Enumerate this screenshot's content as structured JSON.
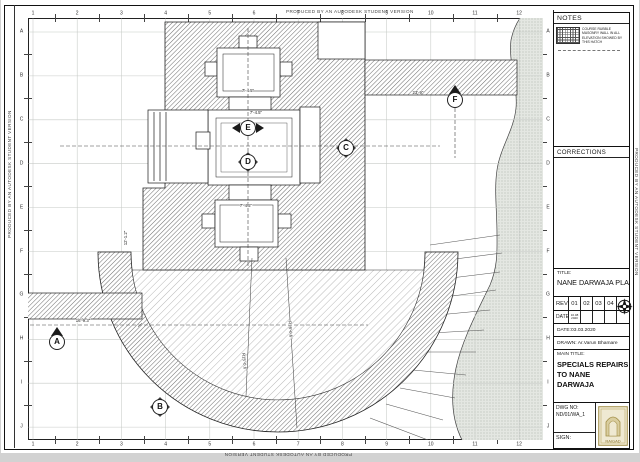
{
  "border": {
    "autodesk_text": "PRODUCED BY AN AUTODESK STUDENT VERSION",
    "top_numbers": [
      "1",
      "2",
      "3",
      "4",
      "5",
      "6",
      "7",
      "8",
      "9",
      "10",
      "11",
      "12"
    ],
    "bottom_numbers": [
      "1",
      "2",
      "3",
      "4",
      "5",
      "6",
      "7",
      "8",
      "9",
      "10",
      "11",
      "12"
    ],
    "left_letters": [
      "A",
      "B",
      "C",
      "D",
      "E",
      "F",
      "G",
      "H",
      "I",
      "J"
    ],
    "right_letters": [
      "A",
      "B",
      "C",
      "D",
      "E",
      "F",
      "G",
      "H",
      "I",
      "J"
    ]
  },
  "titleblock": {
    "notes_header": "NOTES",
    "notes_legend": "COURSE RUBBLE MASONRY WALL IN ALL ELEVATION SHOWED BY THIS HATCH",
    "corrections_header": "CORRECTIONS",
    "title_label": "TITLE:",
    "title_value": "NANE DARWAJA PLAN",
    "rev_label": "REV",
    "rev_cells": [
      "01",
      "02",
      "03",
      "04"
    ],
    "date_label": "DATE",
    "date_cell": "16.08 2020",
    "date_line": "DATE:03.03.2020",
    "drawn_line": "DRAWN: Ar.Varun Bhamare",
    "main_title_label": "MAIN TITLE:",
    "main_title_line1": "SPECIALS REPAIRS",
    "main_title_line2": "TO NANE DARWAJA",
    "dwg_label": "DWG NO:",
    "dwg_value": "ND/01/WA_1",
    "sign_label": "SIGN:",
    "stamp_text": "RAIGAD"
  },
  "plan": {
    "markers": [
      {
        "label": "A",
        "x": 57,
        "y": 342,
        "type": "up"
      },
      {
        "label": "B",
        "x": 160,
        "y": 407,
        "type": "diamond"
      },
      {
        "label": "C",
        "x": 346,
        "y": 148,
        "type": "diamond"
      },
      {
        "label": "D",
        "x": 248,
        "y": 162,
        "type": "diamond"
      },
      {
        "label": "E",
        "x": 248,
        "y": 128,
        "type": "lr"
      },
      {
        "label": "F",
        "x": 455,
        "y": 100,
        "type": "up"
      }
    ],
    "dimensions": [
      {
        "text": "7'-4.5\"",
        "x": 248,
        "y": 92,
        "rot": 0
      },
      {
        "text": "7'-4.5\"",
        "x": 256,
        "y": 114,
        "rot": 0
      },
      {
        "text": "7'-4.5\"",
        "x": 246,
        "y": 207,
        "rot": 0
      },
      {
        "text": "12'-1.2\"",
        "x": 127,
        "y": 238,
        "rot": -90
      },
      {
        "text": "16'-9.3\"",
        "x": 83,
        "y": 322,
        "rot": 0
      },
      {
        "text": "23'-9\"",
        "x": 418,
        "y": 94,
        "rot": 0
      },
      {
        "text": "R15'-0.6\"",
        "x": 243,
        "y": 362,
        "rot": 84
      },
      {
        "text": "R18'-0.6\"",
        "x": 289,
        "y": 330,
        "rot": 86
      }
    ]
  },
  "colors": {
    "hatch_line": "#6a6a6a",
    "terrain_dot": "#9fa89d",
    "stamp_gold": "#a3904a",
    "grid": "#c6cac6"
  }
}
